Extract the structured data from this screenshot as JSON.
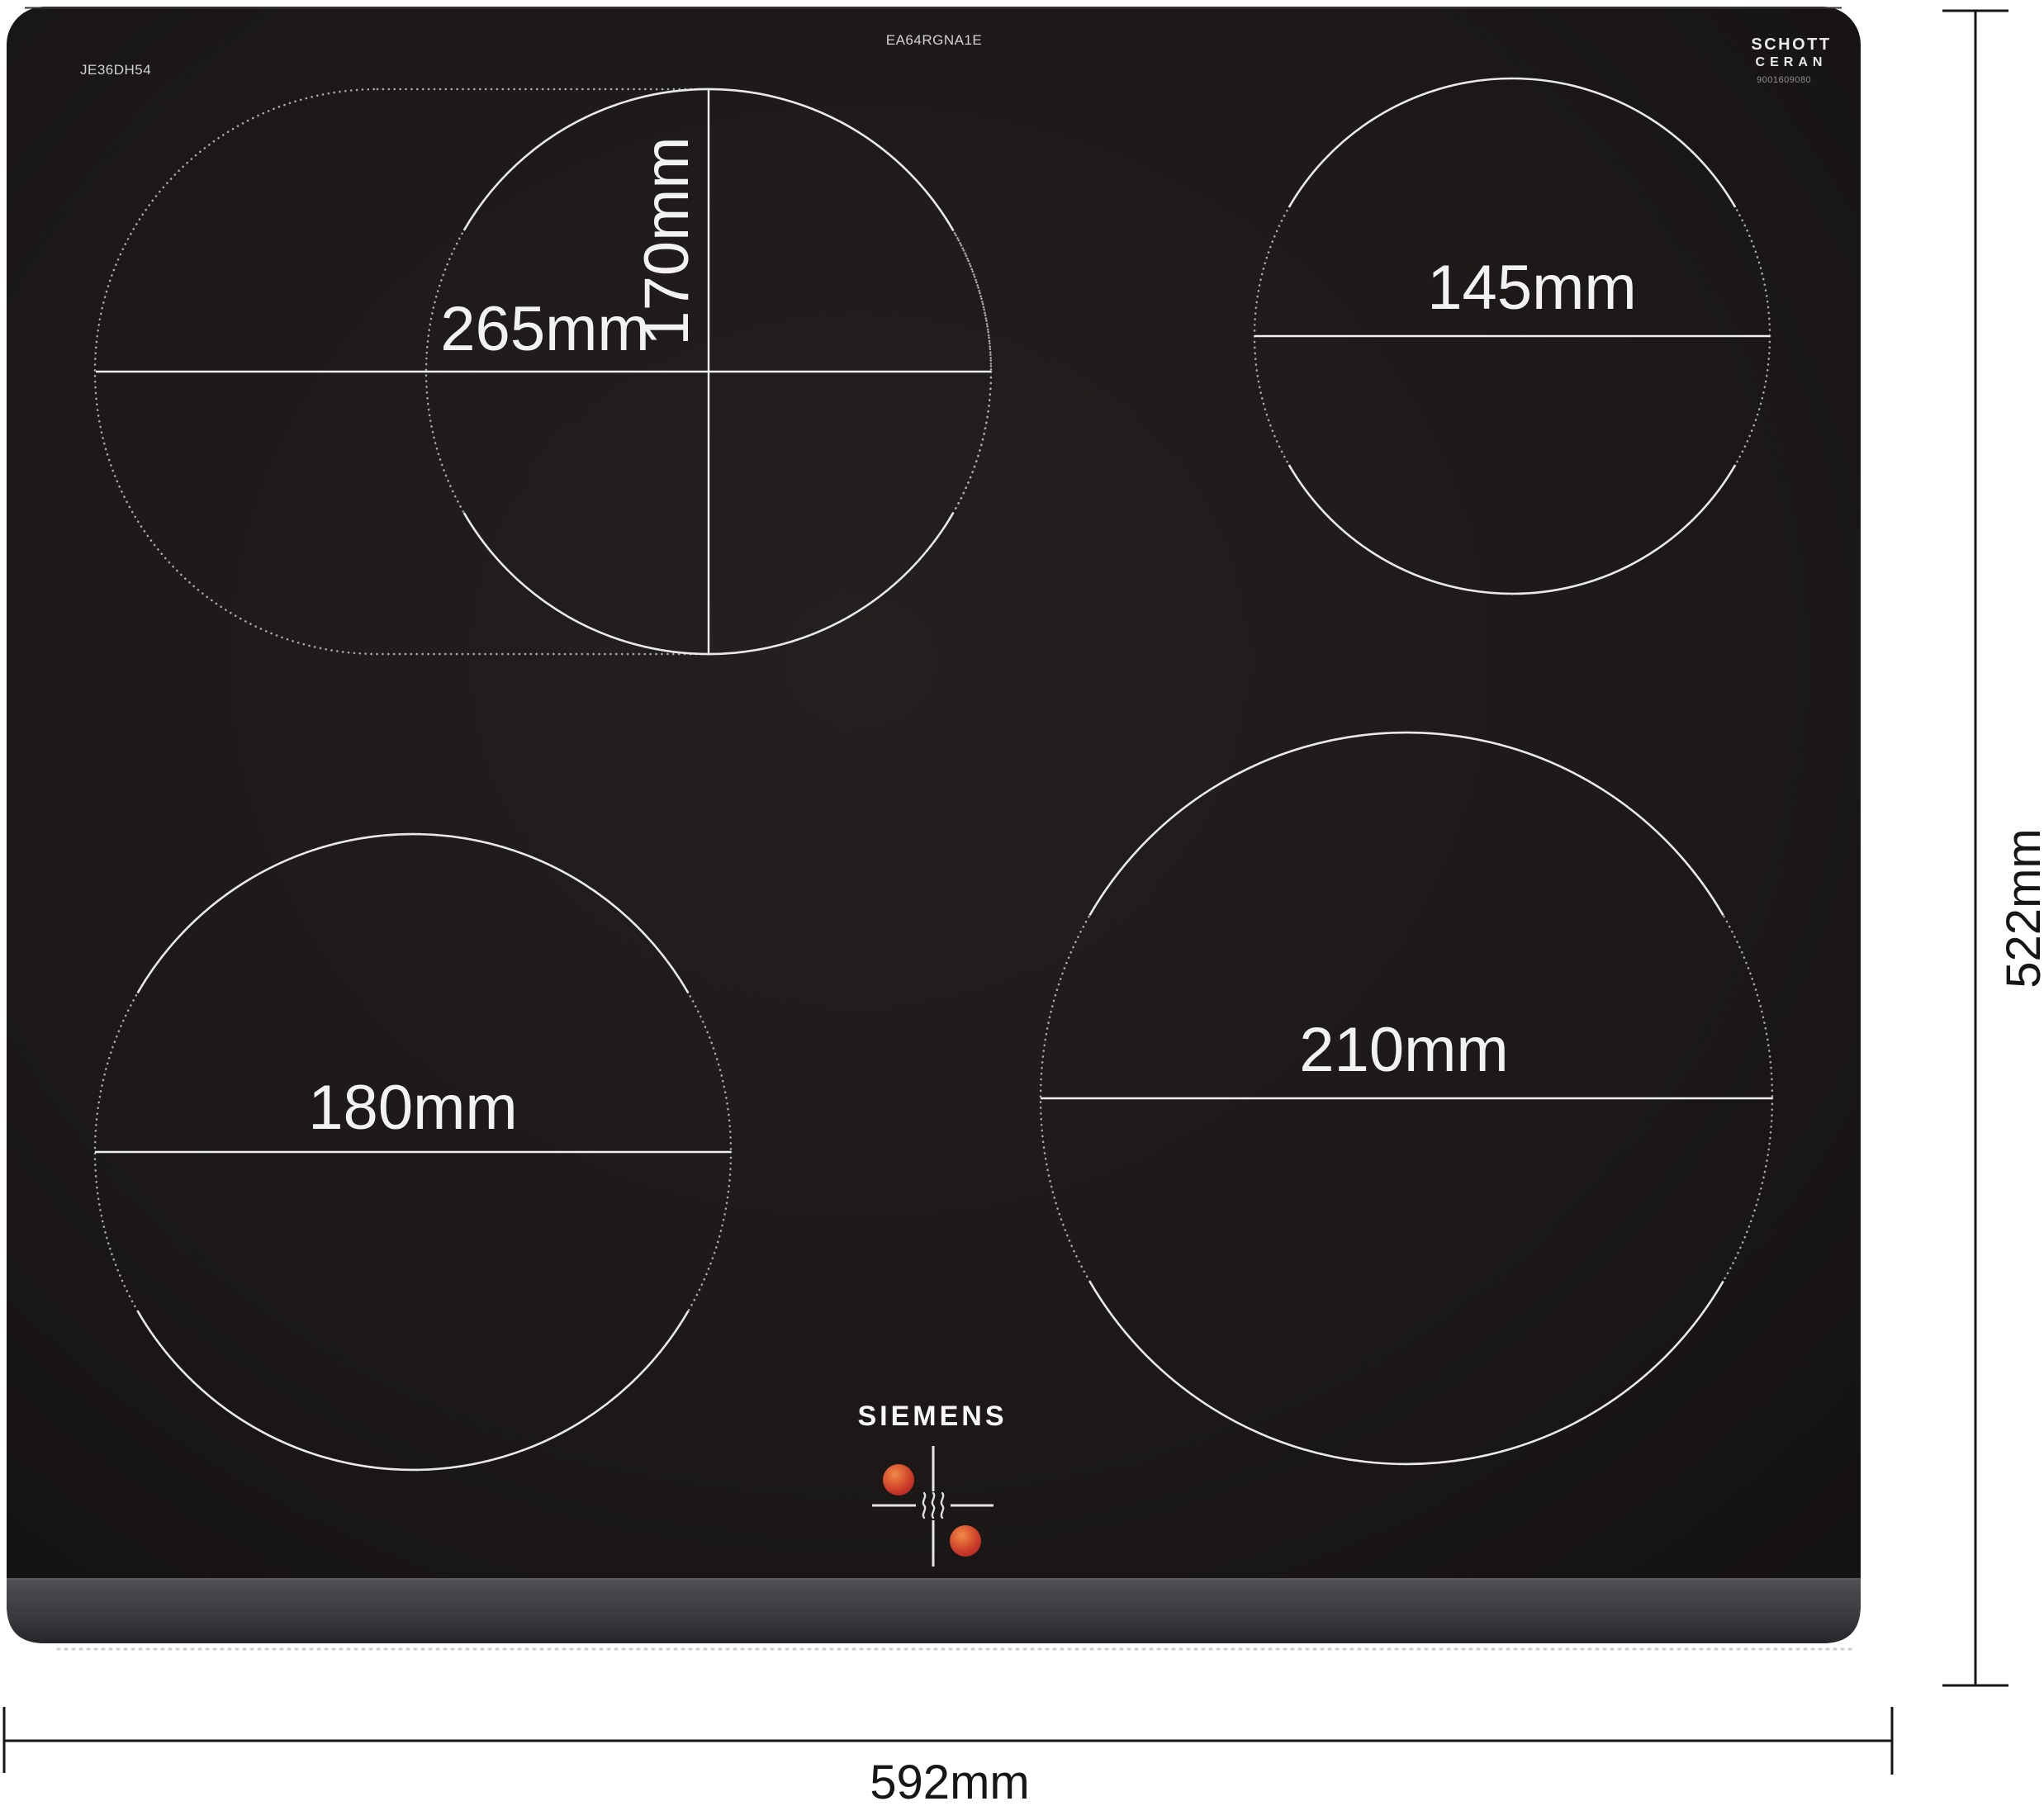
{
  "header": {
    "model_number": "JE36DH54",
    "type_code": "EA64RGNA1E",
    "glass_brand_line1": "SCHOTT",
    "glass_brand_line2": "CERAN",
    "glass_brand_number": "9001609080"
  },
  "brand": {
    "logo_text": "SIEMENS"
  },
  "zones": {
    "top_left_extended_label": "265mm",
    "top_left_inner_label": "170mm",
    "top_right_label": "145mm",
    "bottom_left_label": "180mm",
    "bottom_right_label": "210mm"
  },
  "overall_dimensions": {
    "width_label": "592mm",
    "depth_label": "522mm"
  },
  "icons": {
    "residual_heat_dot": "filled orange-red circle",
    "heat_waves_icon": "three vertical wavy lines"
  },
  "colors": {
    "glass_black": "#1c1818",
    "bevel_gray": "#434347",
    "zone_stroke": "#e9e9e9",
    "dotted_stroke": "#a8a8a8",
    "dimension_black": "#161616",
    "indicator_red": "#c63529",
    "indicator_orange": "#e5793f",
    "background": "#ffffff"
  }
}
